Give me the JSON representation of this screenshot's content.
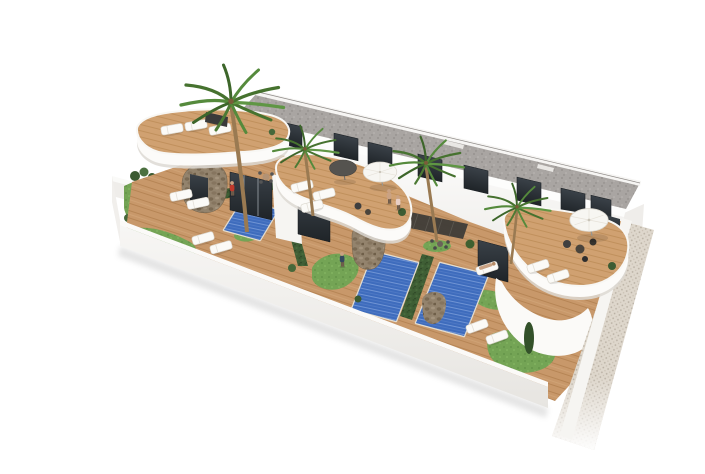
{
  "meta": {
    "title": "Aerial 3D architectural render of a row of modern townhouses with private pools",
    "type": "architectural-visualization",
    "background": "#ffffff"
  },
  "scene": {
    "units_visible": 3,
    "pools": 3,
    "palm_trees": 4,
    "parasols_white": 2,
    "parasols_dark": 1,
    "sun_loungers": 13,
    "people": 5
  },
  "labels": {
    "scene_title": "New-build townhouse complex: white curved roof terraces, timber decks, pools, palm garden",
    "building": "Two-storey white residential block with gravel flat roof and dark windows",
    "terraces": "Curved white roof terraces with timber decking, parasols and sun loungers",
    "pools": "Private blue swimming pools between clipped hedges",
    "garden": "Landscaped garden with palm trees, cypresses and lawn",
    "perimeter": "White perimeter wall with textured pavement along the street side"
  },
  "colors": {
    "background": "#ffffff",
    "wall_white": "#fbfaf8",
    "wall_shade": "#ecebe7",
    "roof_gray": "#a9a5a2",
    "window_dark": "#282d31",
    "wood_deck": "#c8986a",
    "wood_terrace": "#d0a171",
    "pool_blue": "#3e6cbd",
    "pool_deep": "#2d52a0",
    "grass_green": "#74a455",
    "hedge_green": "#3f5e35",
    "palm_green": "#4e7c38",
    "stone_tan": "#93836d",
    "sidewalk": "#ded7cc",
    "shadow": "rgba(60,55,50,0.16)"
  }
}
